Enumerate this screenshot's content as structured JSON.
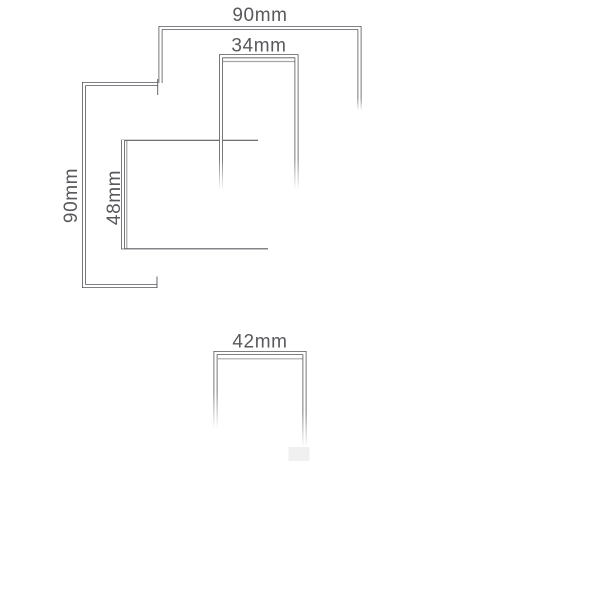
{
  "drawing": {
    "kind": "technical-dimension-diagram",
    "dimensions": [
      {
        "id": "overall-width",
        "label": "90mm",
        "orientation": "horizontal"
      },
      {
        "id": "inner-width",
        "label": "34mm",
        "orientation": "horizontal"
      },
      {
        "id": "overall-height",
        "label": "90mm",
        "orientation": "vertical"
      },
      {
        "id": "body-height",
        "label": "48mm",
        "orientation": "vertical"
      },
      {
        "id": "depth",
        "label": "42mm",
        "orientation": "horizontal"
      }
    ],
    "colors": {
      "background": "#ffffff",
      "dimension_line": "#55555a",
      "object_line": "#5c5c60",
      "text": "#59595d"
    }
  }
}
